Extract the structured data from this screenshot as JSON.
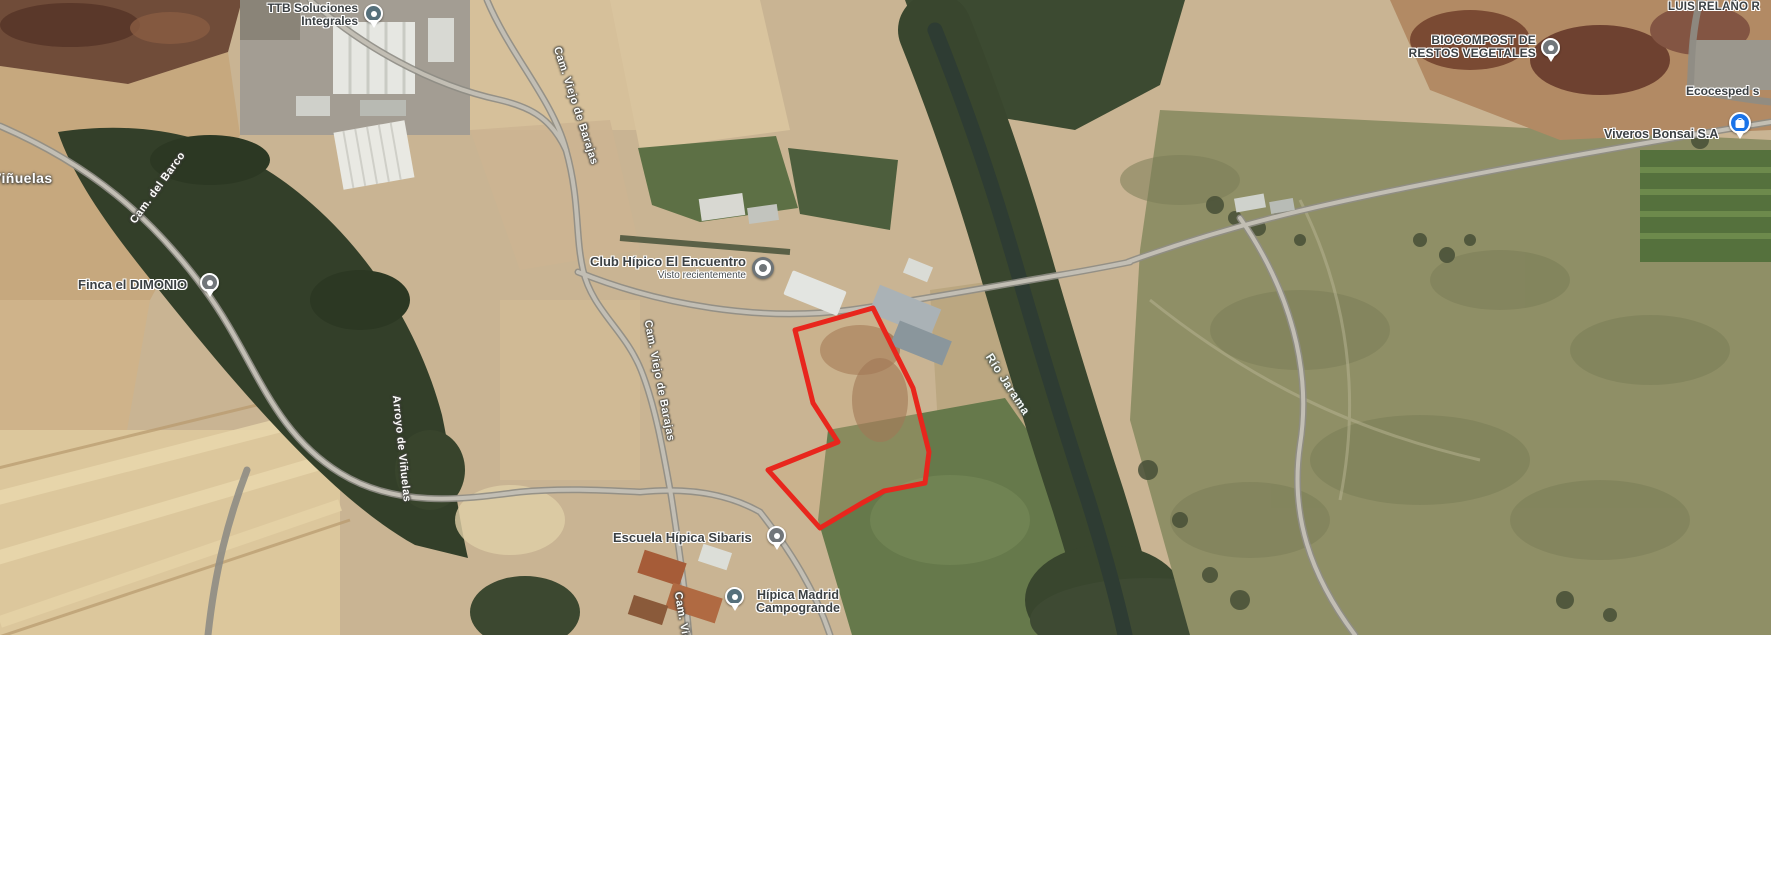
{
  "map": {
    "poi_labels": {
      "ttb": {
        "line1": "TTB Soluciones",
        "line2": "Integrales"
      },
      "biocompost": {
        "line1": "BIOCOMPOST DE",
        "line2": "RESTOS VEGETALES"
      },
      "luis_relano": "LUIS RELAÑO R",
      "ecocesped": "Ecocesped s",
      "viveros": "Viveros Bonsai S.A",
      "finca": "Finca el DIMONIO",
      "club": {
        "name": "Club Hípico El Encuentro",
        "sub": "Visto recientemente"
      },
      "escuela": "Escuela Hípica Sibaris",
      "hipica": {
        "line1": "Hípica Madrid",
        "line2": "Campogrande"
      },
      "vinuelas": "Viñuelas"
    },
    "road_labels": {
      "cam_del_barco": "Cam. del Barco",
      "cam_viejo_north": "Cam. Viejo de Barajas",
      "cam_viejo_mid": "Cam. Viejo de Barajas",
      "cam_viejo_south": "Cam. Viejo de Barajas",
      "arroyo": "Arroyo de Viñuelas",
      "rio": "Río Jarama"
    },
    "colors": {
      "parcel_outline": "#e8261d",
      "poi_pin_slate": "#56707b",
      "poi_pin_gray": "#71767a",
      "visited_marker_gray": "#6e7477",
      "shop_pin_blue": "#1a73e8"
    }
  }
}
